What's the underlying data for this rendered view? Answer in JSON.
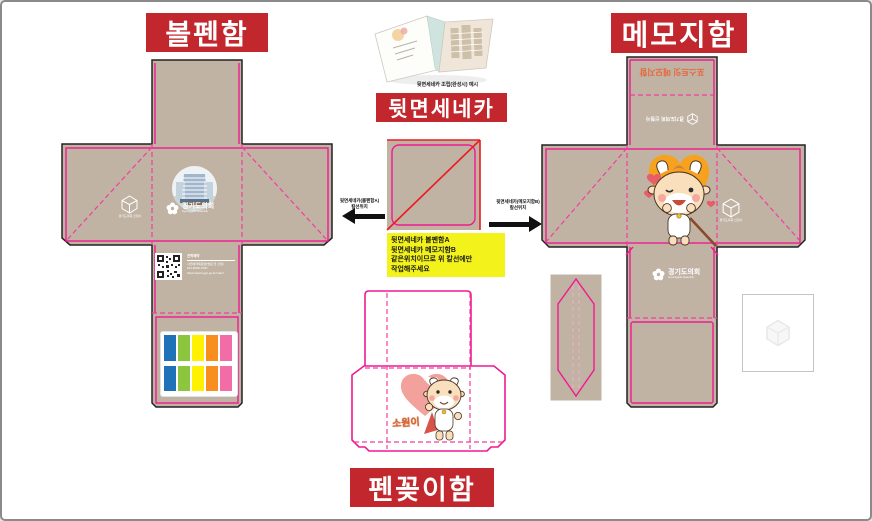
{
  "banners": {
    "ballpen": "볼펜함",
    "memo": "메모지함",
    "seneca": "뒷면세네카",
    "penholder": "펜꽂이함"
  },
  "example": {
    "caption": "뒷면세네카 조립(완성시) 예시"
  },
  "note": {
    "line1": "뒷면세네카 볼펜함A",
    "line2": "뒷면세네카 메모지함B",
    "line3": "같은위치이므로  위 칼선에만",
    "line4": "작업해주세요"
  },
  "arrow_labels": {
    "left_line1": "뒷면세네카(볼펜함A)",
    "left_line2": "칼선위치",
    "right_line1": "뒷면세네카(메모지함B)",
    "right_line2": "칼선위치"
  },
  "assembly": {
    "name": "경기도의회",
    "name_en": "Gyeonggido Assembly"
  },
  "hex_logo": {
    "caption": "경기도의회 신청사"
  },
  "qr": {
    "title": "견학예약",
    "line1": "사전예약제운영(방문 전 신청)",
    "line2": "031-8008-7000",
    "line3": "https://www.ggc.go.kr/main/"
  },
  "memo_lid": {
    "flip_text": "포스트잇 메모지함",
    "flip_logo_caption": "경기도의회 신청사"
  },
  "mascot": {
    "name_label": "소원이"
  },
  "colors": {
    "banner_red": "#C1272D",
    "kraft": "#C1B3A4",
    "cut_pink": "#EF1A8F",
    "fold_pink": "#F23D9E",
    "diag_red": "#EB1C24",
    "note_yellow": "#F3F31B",
    "heart_orange": "#F6A21F",
    "heart_pink": "#F2A19C",
    "sticky": [
      "#1F72B8",
      "#8CC63F",
      "#FFF100",
      "#F78E1E",
      "#F26CA8"
    ]
  }
}
